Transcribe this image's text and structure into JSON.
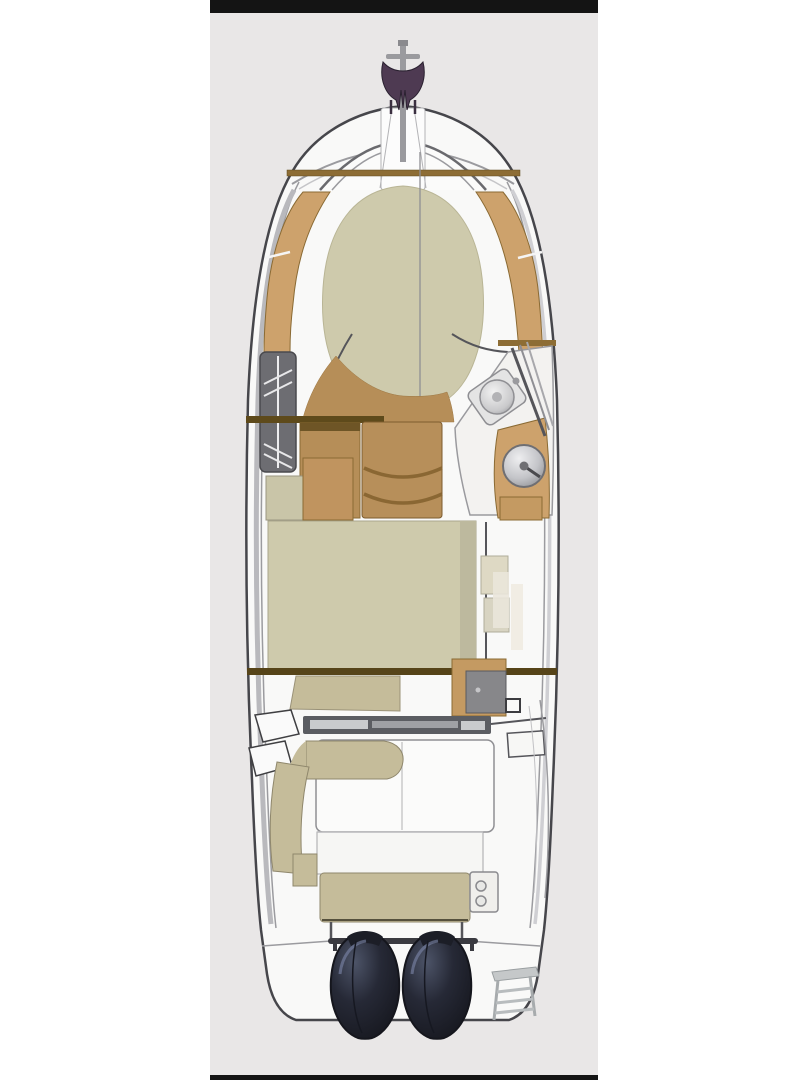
{
  "scene": {
    "type": "boat-deck-plan",
    "description": "Overhead interior layout plan of an express-cruiser motor yacht: bow sunpad/V-berth, head compartment, dinette, galley with sink, helm with steering wheel, mid-cabin berth, cockpit seating, aft bench, twin dark engines and a swim ladder, shown on a light gray photo panel with black bars at top and bottom.",
    "text_content": "none"
  },
  "elements": [
    "top-black-bar",
    "photo-panel-background",
    "hull",
    "bow-pulpit",
    "anchor-windlass",
    "foredeck-rail",
    "bow-sunpad",
    "side-trim-port",
    "side-trim-starboard",
    "head-compartment-hatch",
    "windshield-pillars",
    "salon-floor",
    "dinette-seat",
    "salon-cabinet",
    "galley-counter",
    "galley-sink",
    "helm-console",
    "steering-wheel",
    "windshield-frame",
    "mid-cabin-berth",
    "companionway-steps",
    "cabin-sideboard",
    "wet-bar-cabinet",
    "cockpit-door-track",
    "transom-gate",
    "cockpit-l-seat",
    "cockpit-cushions",
    "aft-bench",
    "cupholder-module",
    "side-boarding-step",
    "transom-rail",
    "port-engine",
    "starboard-engine",
    "swim-ladder",
    "bottom-black-bar"
  ],
  "colors": {
    "page_bg": "#ffffff",
    "panel_bg": "#e9e7e7",
    "bar_black": "#141414",
    "hull_outline": "#46464b",
    "hull_fill": "#f9f9f8",
    "line_gray": "#9b9b9f",
    "line_dark": "#55555a",
    "cushion_beige": "#cecaac",
    "cushion_khaki": "#c5bc9a",
    "cushion_white": "#fbfbfa",
    "wood_tan": "#cda26c",
    "wood_mid": "#b68e58",
    "wood_dark": "#6e5526",
    "bulkhead_brown": "#5e4a1b",
    "bulkhead_tan": "#8d6d35",
    "track_gray": "#5b5d62",
    "console_white": "#f3f2f0",
    "hatch_gray": "#6d6d72",
    "anchor_purple": "#4e3a52",
    "metal_light": "#c7c9cb",
    "step_beige": "#ded9c4",
    "engine_base": "#262936",
    "engine_highlight": "#4d5468",
    "engine_dark": "#15161d"
  }
}
